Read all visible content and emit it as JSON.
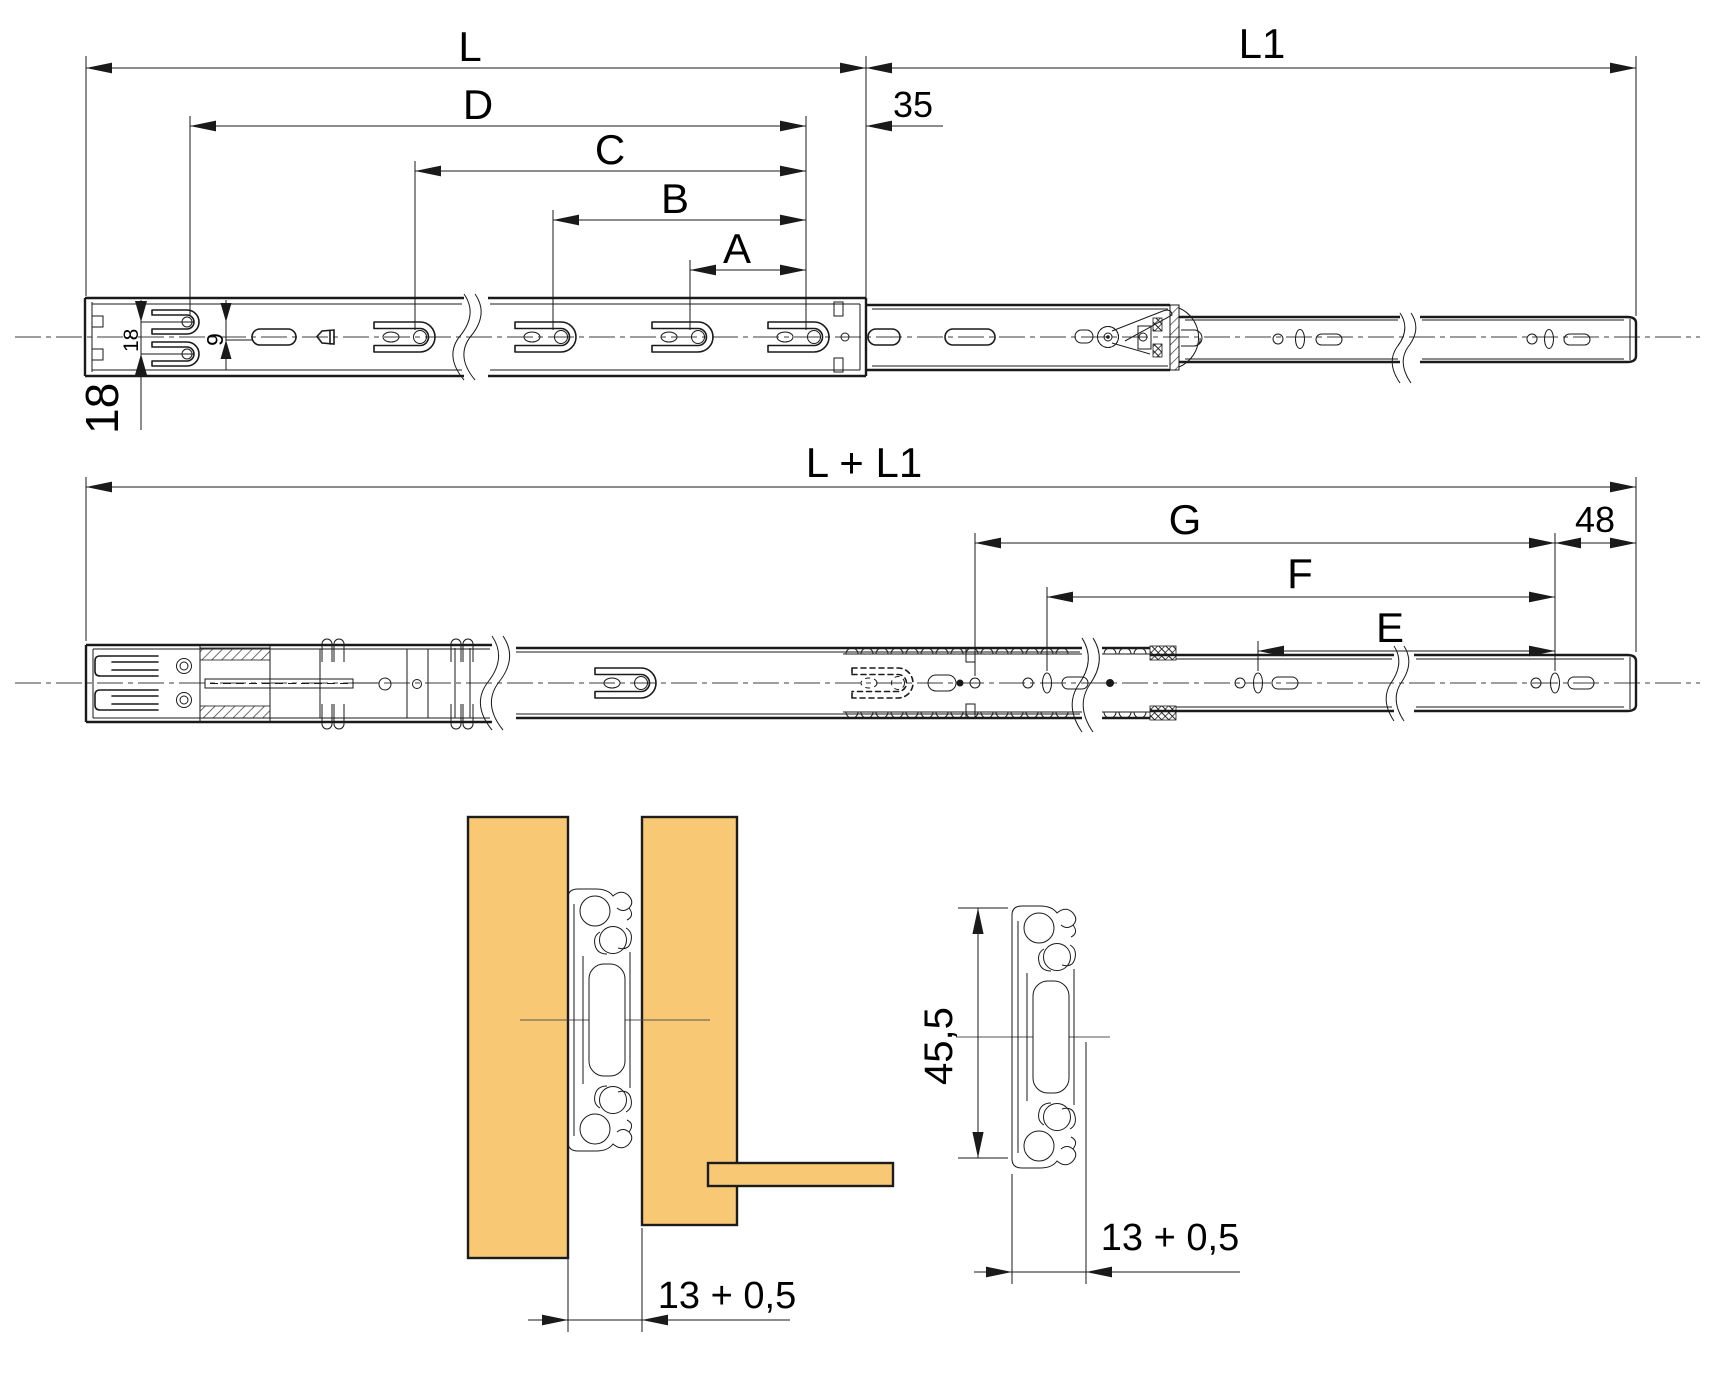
{
  "colors": {
    "line": "#1a1a1a",
    "wood": "#f8c875",
    "centerline": "#3c3c3c",
    "background": "#ffffff"
  },
  "closed_view": {
    "L": "L",
    "L1": "L1",
    "D": "D",
    "C": "C",
    "B": "B",
    "A": "A",
    "front_offset": "35",
    "row_spacing": "18",
    "row_offset": "9",
    "edge_offset": "18"
  },
  "extended_view": {
    "total": "L + L1",
    "G": "G",
    "F": "F",
    "E": "E",
    "front_offset": "48"
  },
  "installed_section": {
    "groove": "13 + 0,5"
  },
  "profile_section": {
    "height": "45,5",
    "groove": "13 + 0,5"
  }
}
